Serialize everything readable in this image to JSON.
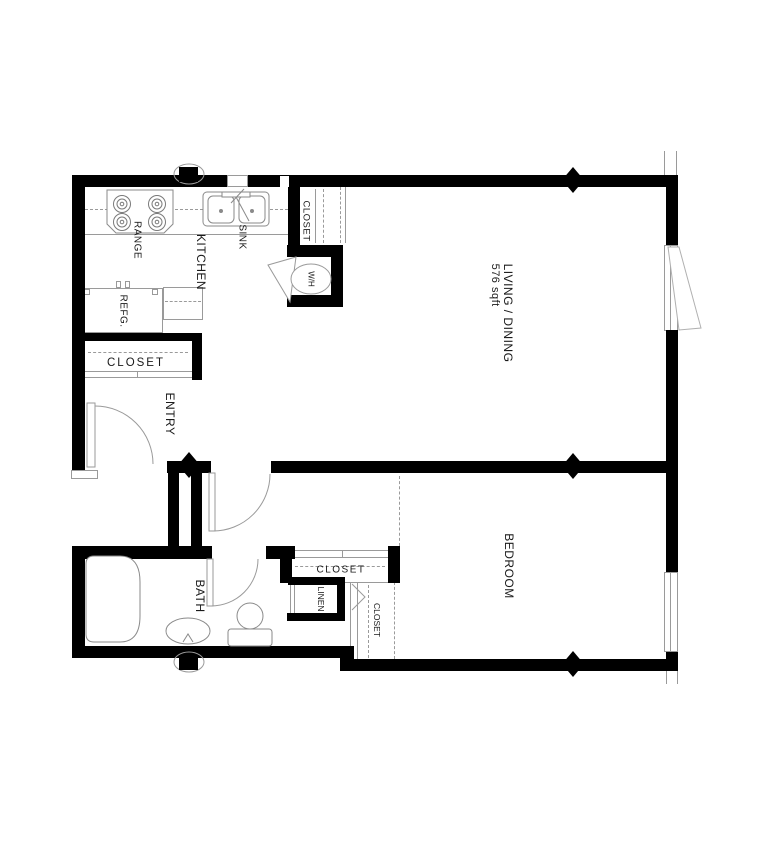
{
  "labels": {
    "kitchen": "KITCHEN",
    "range": "RANGE",
    "sink": "SINK",
    "refrigerator": "REFG.",
    "kitchen_closet": "CLOSET",
    "water_heater": "W/H",
    "living_dining": "LIVING / DINING",
    "living_dining_area": "576 sqft",
    "entry_closet": "CLOSET",
    "entry": "ENTRY",
    "bath": "BATH",
    "bedroom": "BEDROOM",
    "bedroom_closet": "CLOSET",
    "linen": "LINEN",
    "bedroom_closet_2": "CLOSET"
  },
  "colors": {
    "wall": "#000000",
    "detail_line": "#9a9a9a",
    "text": "#1a1a1a",
    "background": "#ffffff"
  }
}
